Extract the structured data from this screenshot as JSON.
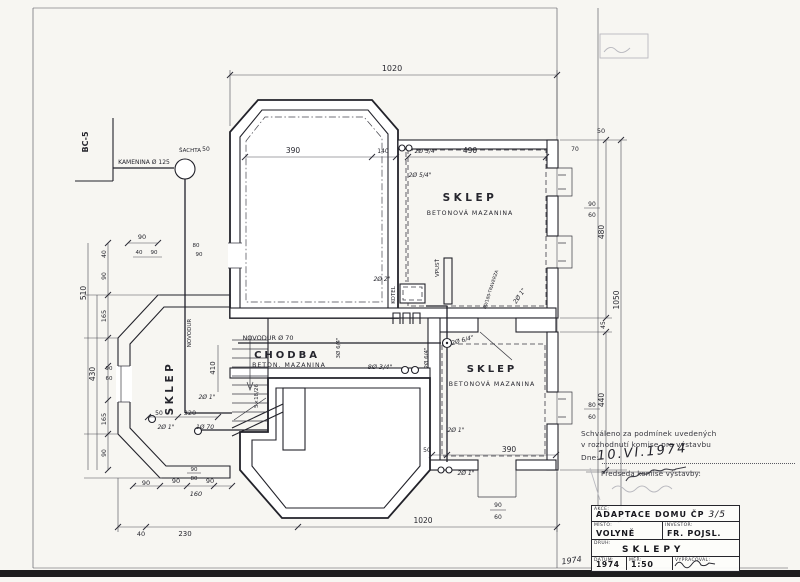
{
  "drawing": {
    "site": {
      "corner_ref": "BC-5",
      "sewer_pipe": "KAMENINA Ø 125",
      "shaft": "ŠACHTA"
    },
    "rooms": {
      "sklep_top": {
        "name": "SKLEP",
        "floor": "BETONOVÁ MAZANINA"
      },
      "sklep_right": {
        "name": "SKLEP",
        "floor": "BETONOVÁ MAZANINA"
      },
      "sklep_bay": {
        "name": "SKLEP"
      },
      "chodba": {
        "name": "CHODBA",
        "floor": "BETON. MAZANINA"
      }
    },
    "annotations": {
      "novodur": "NOVODUR Ø 70",
      "novodur_v": "NOVODUR",
      "kotel": "KOTEL",
      "vpust": "VPUSŤ",
      "traverza": "80/180-TRAVERZA",
      "stair_note": "5×18/26",
      "p2x2": "2Ø 2\"",
      "p2x54_a": "2Ø 5/4\"",
      "p2x54_b": "2Ø 5/4\"",
      "p8x34": "8Ø 3/4\"",
      "p3x64": "3Ø 6/4\"",
      "p2x64_a": "2Ø 6/4\"",
      "p2x64_b": "2Ø 6/4\"",
      "p2x1_a": "2Ø 1\"",
      "p2x1_b": "2Ø 1\"",
      "p2x1_c": "2Ø 1\"",
      "p2x1_d": "2Ø 1\"",
      "p2x1_e": "2Ø 1\"",
      "p1x70": "1Ø 70"
    },
    "dims": {
      "top_overall": "1020",
      "bottom_overall": "1020",
      "b40": "40",
      "b230": "230",
      "c90a": "90",
      "c90b": "90",
      "c90c": "90",
      "c90d": "90",
      "c80": "80",
      "c160": "160",
      "r390": "390",
      "r140": "140",
      "wall50": "50",
      "rr490": "490",
      "rr70": "70",
      "rr50": "50",
      "rw90": "90",
      "rw60": "60",
      "r480": "480",
      "r1050": "1050",
      "r45": "45",
      "r440": "440",
      "rw80": "80",
      "rw60b": "60",
      "l90": "90",
      "l40": "40",
      "l90b": "90",
      "v40": "40",
      "v90a": "90",
      "v165a": "165",
      "vw90": "90",
      "vw60": "60",
      "v165b": "165",
      "v90b": "90",
      "v430": "430",
      "v510": "510",
      "bay410": "410",
      "bay50": "50",
      "bay320": "320",
      "n80": "80",
      "n90": "90",
      "br390": "390",
      "br50": "50",
      "bw90": "90",
      "bw60": "60"
    }
  },
  "stamp": {
    "line1": "Schváleno za podmínek uvedených",
    "line2": "v rozhodnutí komise pro výstavbu",
    "dne_label": "Dne:",
    "date": "10.VI.1974",
    "chairman": "Předseda komise výstavby:"
  },
  "title_block": {
    "akce_label": "AKCE:",
    "project_title": "ADAPTACE DOMU ČP",
    "project_number": "3/5",
    "misto_label": "MÍSTO:",
    "misto": "VOLYNĚ",
    "investor_label": "INVESTOR:",
    "investor": "FR. POJSL.",
    "druh_label": "DRUH:",
    "druh": "SKLEPY",
    "datum_label": "DATUM:",
    "datum": "1974",
    "mer_label": "MĚŘ:",
    "mer": "1:50",
    "vypracoval_label": "VYPRACOVAL:"
  },
  "margin_note": "1974"
}
